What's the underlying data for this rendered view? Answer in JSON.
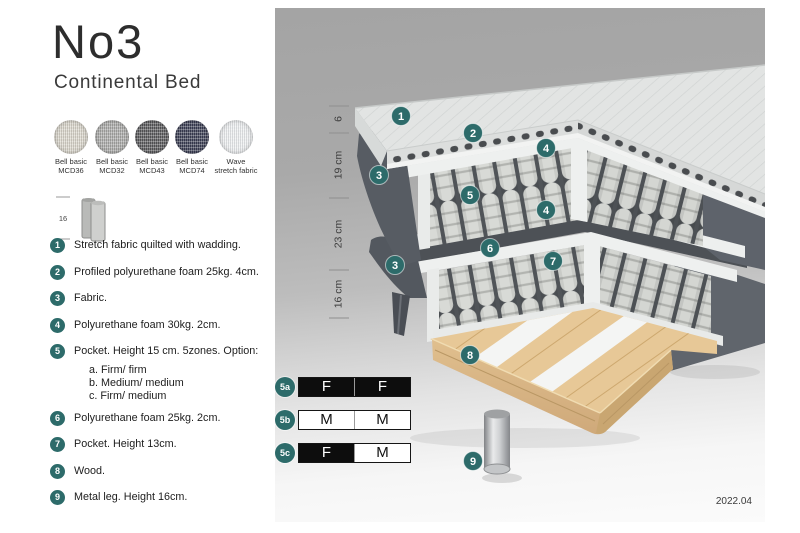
{
  "header": {
    "title": "No3",
    "subtitle": "Continental Bed"
  },
  "swatches": [
    {
      "line1": "Bell basic",
      "line2": "MCD36",
      "color": "#d8d4c9"
    },
    {
      "line1": "Bell basic",
      "line2": "MCD32",
      "color": "#a8a8a6"
    },
    {
      "line1": "Bell basic",
      "line2": "MCD43",
      "color": "#58585a"
    },
    {
      "line1": "Bell basic",
      "line2": "MCD74",
      "color": "#3a3d53"
    },
    {
      "line1": "Wave",
      "line2": "stretch fabric",
      "color": "#eceef0"
    }
  ],
  "leg_icon": {
    "height_label": "16"
  },
  "legend": [
    {
      "num": "1",
      "text": "Stretch fabric quilted with wadding."
    },
    {
      "num": "2",
      "text": "Profiled polyurethane foam 25kg. 4cm."
    },
    {
      "num": "3",
      "text": "Fabric."
    },
    {
      "num": "4",
      "text": "Polyurethane foam 30kg. 2cm."
    },
    {
      "num": "5",
      "text": "Pocket. Height 15 cm. 5zones. Option:",
      "options": [
        "a. Firm/ firm",
        "b. Medium/ medium",
        "c. Firm/ medium"
      ]
    },
    {
      "num": "6",
      "text": "Polyurethane foam 25kg. 2cm."
    },
    {
      "num": "7",
      "text": "Pocket. Height 13cm."
    },
    {
      "num": "8",
      "text": "Wood."
    },
    {
      "num": "9",
      "text": "Metal leg. Height 16cm."
    }
  ],
  "diagram": {
    "dimensions": [
      "6",
      "19 cm",
      "23 cm",
      "16 cm"
    ],
    "callouts": [
      "1",
      "2",
      "4",
      "3",
      "5",
      "4",
      "6",
      "7",
      "3",
      "8",
      "9"
    ],
    "version": "2022.04"
  },
  "firmness": {
    "rows": [
      {
        "id": "5a",
        "cells": [
          "F",
          "F"
        ],
        "cell_styles": [
          "dark",
          "dark"
        ]
      },
      {
        "id": "5b",
        "cells": [
          "M",
          "M"
        ],
        "cell_styles": [
          "light",
          "light"
        ]
      },
      {
        "id": "5c",
        "cells": [
          "F",
          "M"
        ],
        "cell_styles": [
          "dark",
          "light"
        ]
      }
    ]
  },
  "colors": {
    "accent_teal": "#2d6b6a",
    "panel_gray_top": "#a4a4a4",
    "panel_gray_bottom": "#fbfbfb",
    "fabric_dark_gray": "#5e636b",
    "wood_tan": "#e7c897",
    "spring_light": "#d8dad6"
  }
}
